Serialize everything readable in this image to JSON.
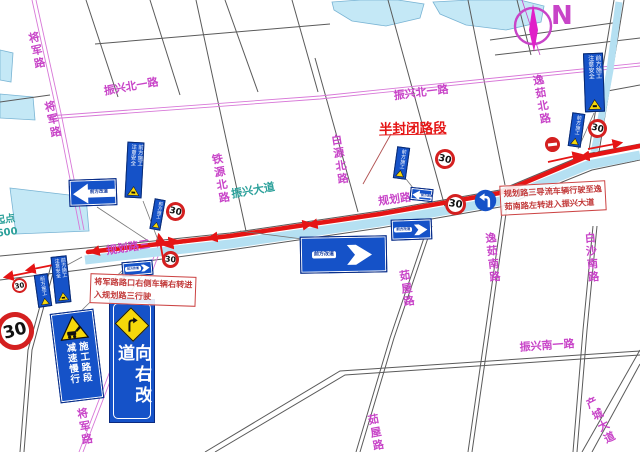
{
  "colors": {
    "road_pink": "#d878d8",
    "label_pink": "#c844c8",
    "label_teal": "#2ba09a",
    "closure_red": "#e51515",
    "annotation_red": "#c23a3a",
    "sign_blue": "#1552c8",
    "sign_blue_dark": "#123a9e",
    "warning_yellow": "#f6d80a",
    "road_cyan": "#b5e0f2",
    "water": "#c4e8f6",
    "road_gray": "#5a5a5a",
    "speed_ring_red": "#d42020"
  },
  "compass": {
    "north_label": "N"
  },
  "annotations": {
    "closed_section_label": "半封闭路段",
    "note_jiangjun": {
      "line1": "将军路路口右侧车辆右转进",
      "line2": "入规划路三行驶"
    },
    "note_guihua": {
      "line1": "规划路三导流车辆行驶至逸",
      "line2": "茹南路左转进入振兴大道"
    },
    "distance_note": {
      "line1": "距起点",
      "line2": "约600"
    }
  },
  "map": {
    "road_labels": [
      {
        "text": "将军路",
        "x": 36,
        "y": 51,
        "rot": -12,
        "vertical": true,
        "color": "pink"
      },
      {
        "text": "将军路",
        "x": 52,
        "y": 120,
        "rot": -12,
        "vertical": true,
        "color": "pink"
      },
      {
        "text": "将军路",
        "x": 84,
        "y": 427,
        "rot": -10,
        "vertical": true,
        "color": "pink"
      },
      {
        "text": "振兴北一路",
        "x": 131,
        "y": 86,
        "rot": -10,
        "vertical": false,
        "color": "pink"
      },
      {
        "text": "振兴北一路",
        "x": 421,
        "y": 92,
        "rot": -7,
        "vertical": false,
        "color": "pink"
      },
      {
        "text": "铁源北路",
        "x": 220,
        "y": 179,
        "rot": -10,
        "vertical": true,
        "color": "pink"
      },
      {
        "text": "白源北路",
        "x": 339,
        "y": 160,
        "rot": -9,
        "vertical": true,
        "color": "pink"
      },
      {
        "text": "逸茹北路",
        "x": 541,
        "y": 100,
        "rot": -10,
        "vertical": true,
        "color": "pink"
      },
      {
        "text": "逸茹南路",
        "x": 492,
        "y": 258,
        "rot": -6,
        "vertical": true,
        "color": "pink"
      },
      {
        "text": "白沙南路",
        "x": 591,
        "y": 258,
        "rot": -5,
        "vertical": true,
        "color": "pink"
      },
      {
        "text": "茹屋路",
        "x": 406,
        "y": 289,
        "rot": -9,
        "vertical": true,
        "color": "pink"
      },
      {
        "text": "茹屋路",
        "x": 375,
        "y": 433,
        "rot": -11,
        "vertical": true,
        "color": "pink"
      },
      {
        "text": "振兴南一路",
        "x": 547,
        "y": 345,
        "rot": -4,
        "vertical": false,
        "color": "pink"
      },
      {
        "text": "产城大道",
        "x": 600,
        "y": 421,
        "rot": -27,
        "vertical": true,
        "color": "pink"
      },
      {
        "text": "规划路三",
        "x": 128,
        "y": 247,
        "rot": -9,
        "vertical": false,
        "color": "pink"
      },
      {
        "text": "规划路二",
        "x": 400,
        "y": 198,
        "rot": -8,
        "vertical": false,
        "color": "pink"
      },
      {
        "text": "振兴大道",
        "x": 253,
        "y": 190,
        "rot": -10,
        "vertical": false,
        "color": "teal"
      }
    ]
  },
  "signs": {
    "speed_limit": "30",
    "construction_board": {
      "col_right": "施工路段",
      "col_left": "减速慢行"
    },
    "detour_right_text": "向右改道",
    "caution_board": {
      "col_right": "前方施工",
      "col_left": "注意安全"
    },
    "small_board_text": "前方施工",
    "arrow_sign_label": "前方改道"
  }
}
